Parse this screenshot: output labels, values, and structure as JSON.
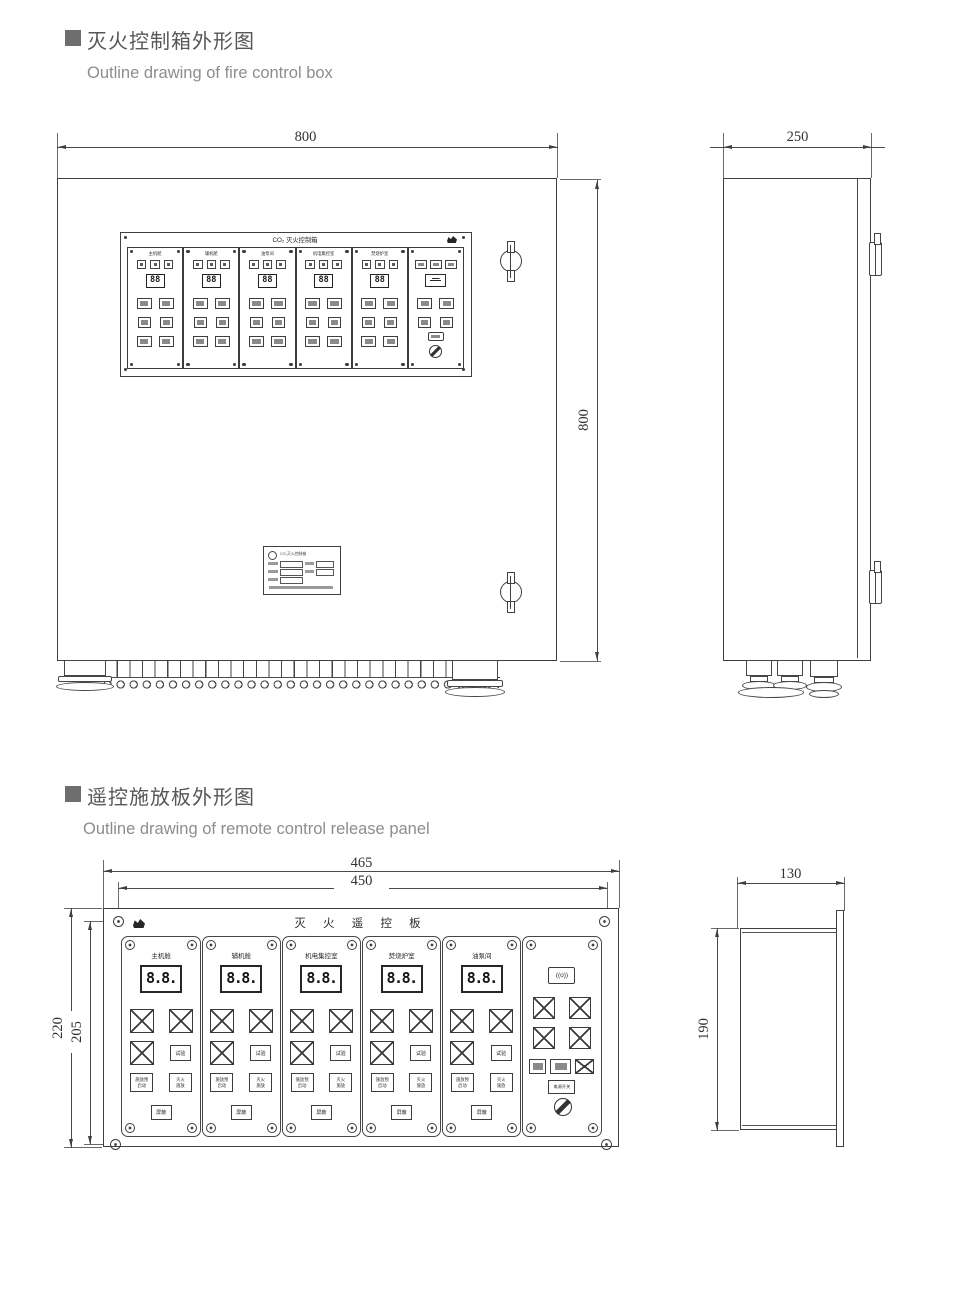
{
  "section_fire_box": {
    "title_cn": "灭火控制箱外形图",
    "title_en": "Outline drawing of fire control box",
    "front_view": {
      "dim_width": "800",
      "dim_height": "800",
      "panel_title": "CO₂ 灭火控制箱",
      "display_value": "88",
      "modules": [
        {
          "label": "主机舱"
        },
        {
          "label": "辅机舱"
        },
        {
          "label": "油泵间"
        },
        {
          "label": "机电集控室"
        },
        {
          "label": "焚烧炉室"
        }
      ],
      "nameplate_title": "CO₂灭火控制箱"
    },
    "side_view": {
      "dim_depth": "250"
    }
  },
  "section_remote_panel": {
    "title_cn": "遥控施放板外形图",
    "title_en": "Outline drawing of remote control release panel",
    "front_view": {
      "dim_outer_width": "465",
      "dim_inner_width": "450",
      "dim_outer_height": "220",
      "dim_inner_height": "205",
      "panel_title": "灭 火 遥 控 板",
      "display_value": "8.8.",
      "modules": [
        {
          "label": "主机舱"
        },
        {
          "label": "辅机舱"
        },
        {
          "label": "机电集控室"
        },
        {
          "label": "焚烧炉室"
        },
        {
          "label": "油泵间"
        }
      ],
      "buttons": {
        "test": "试验",
        "prestart_line1": "施放预",
        "prestart_line2": "启动",
        "release_line1": "灭火",
        "release_line2": "施放",
        "mask": "屏蔽",
        "power_label": "电源开关"
      },
      "sounder_glyph": "((o))"
    },
    "side_view": {
      "dim_depth": "130",
      "dim_height": "190"
    }
  }
}
